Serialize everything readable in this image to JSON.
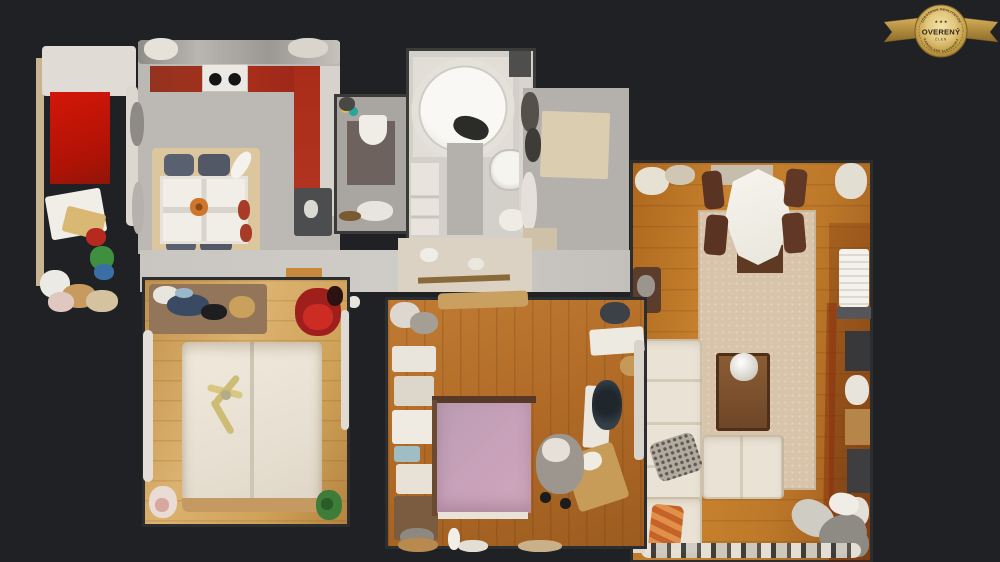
{
  "badge": {
    "arc_top": "ZDRUŽENIE REALITNÝCH",
    "arc_bottom": "KANCELÁRIÍ SLOVENSKA",
    "stars": "★ ★ ★",
    "title": "OVERENÝ",
    "subtitle": "ČLEN",
    "colors": {
      "gold_light": "#f3e3ab",
      "gold": "#cda94f",
      "gold_dark": "#8d6b26",
      "text_dark": "#2f2410"
    }
  },
  "scene": {
    "description": "3D dollhouse top-down scan view of an apartment (virtual tour)",
    "background_color": "#1f2124",
    "rooms": [
      {
        "id": "storage-room",
        "label": "Storage room",
        "floor_colors": [
          "#e0dcd5",
          "#c31508"
        ],
        "items": [
          "shelves",
          "boxes",
          "clutter"
        ]
      },
      {
        "id": "kitchen",
        "label": "Kitchen",
        "floor_color": "#bcb8b4",
        "counter_color": "#a22c18",
        "items": [
          "stove",
          "dining-table",
          "four-chairs",
          "fridge",
          "rug"
        ]
      },
      {
        "id": "wc",
        "label": "WC",
        "floor_color": "#a9a5a1",
        "items": [
          "toilet",
          "dark-mat"
        ]
      },
      {
        "id": "bathroom",
        "label": "Bathroom",
        "floor_color": "#d3cfc9",
        "items": [
          "corner-bathtub",
          "round-sink",
          "cabinet"
        ]
      },
      {
        "id": "hallway",
        "label": "Hallway",
        "floor_color": "#b4b0ab",
        "items": [
          "doormat",
          "shoes",
          "coat-rack"
        ]
      },
      {
        "id": "living-room",
        "label": "Living room",
        "floor_color": "#bd7829",
        "rug_color": "#d8c4aa",
        "items": [
          "dining-table",
          "wood-chairs",
          "corner-sofa",
          "coffee-table",
          "vase",
          "shelving"
        ]
      },
      {
        "id": "bedroom-1",
        "label": "Bedroom 1",
        "floor_color": "#d0a45c",
        "bed_color": "#ece4d7",
        "items": [
          "double-bed",
          "ceiling-fan",
          "closet-shelf",
          "plant"
        ]
      },
      {
        "id": "bedroom-2",
        "label": "Bedroom 2",
        "floor_color": "#b06a26",
        "bed_color": "#c8a2ba",
        "items": [
          "double-bed",
          "wardrobe",
          "desk",
          "office-chair"
        ]
      }
    ]
  }
}
